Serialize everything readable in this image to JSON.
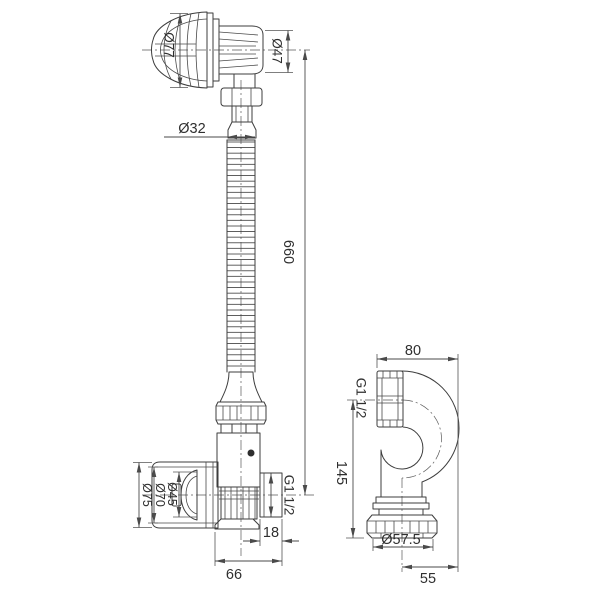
{
  "dimensions": {
    "head_cap_diameter": "Ø77",
    "head_body_diameter": "Ø47",
    "hose_diameter": "Ø32",
    "hose_length": "660",
    "cup_outer_diameter": "Ø75",
    "cup_ring_diameter": "Ø70",
    "plug_diameter": "Ø45",
    "tee_outlet_thread": "G1 1/2",
    "tee_outlet_length": "18",
    "tee_width": "66",
    "trap_width": "80",
    "trap_inlet_thread": "G1 1/2",
    "trap_height": "145",
    "trap_nut_diameter": "Ø57.5",
    "trap_outlet_offset": "55"
  },
  "colors": {
    "line": "#3d3d3d",
    "dimension": "#4a4a4a",
    "text": "#2f2f2f",
    "background": "#ffffff"
  }
}
